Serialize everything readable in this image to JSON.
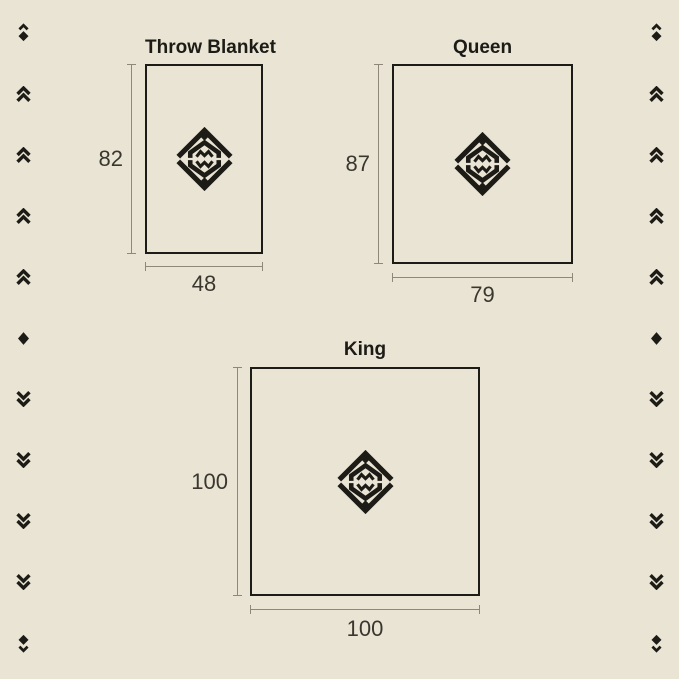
{
  "colors": {
    "background": "#EAE4D4",
    "ink": "#1C1B16",
    "dimension_line": "#8F887A",
    "number_text": "#3A372F"
  },
  "panels": [
    {
      "id": "throw",
      "title": "Throw Blanket",
      "height_label": "82",
      "width_label": "48"
    },
    {
      "id": "queen",
      "title": "Queen",
      "height_label": "87",
      "width_label": "79"
    },
    {
      "id": "king",
      "title": "King",
      "height_label": "100",
      "width_label": "100"
    }
  ],
  "icons": {
    "emblem": "brand-emblem",
    "edge_pattern": [
      "cap-diamond",
      "chevrons-up",
      "chevrons-up",
      "chevrons-up",
      "chevrons-up",
      "diamond",
      "chevrons-down",
      "chevrons-down",
      "chevrons-down",
      "chevrons-down",
      "diamond-tail"
    ]
  }
}
